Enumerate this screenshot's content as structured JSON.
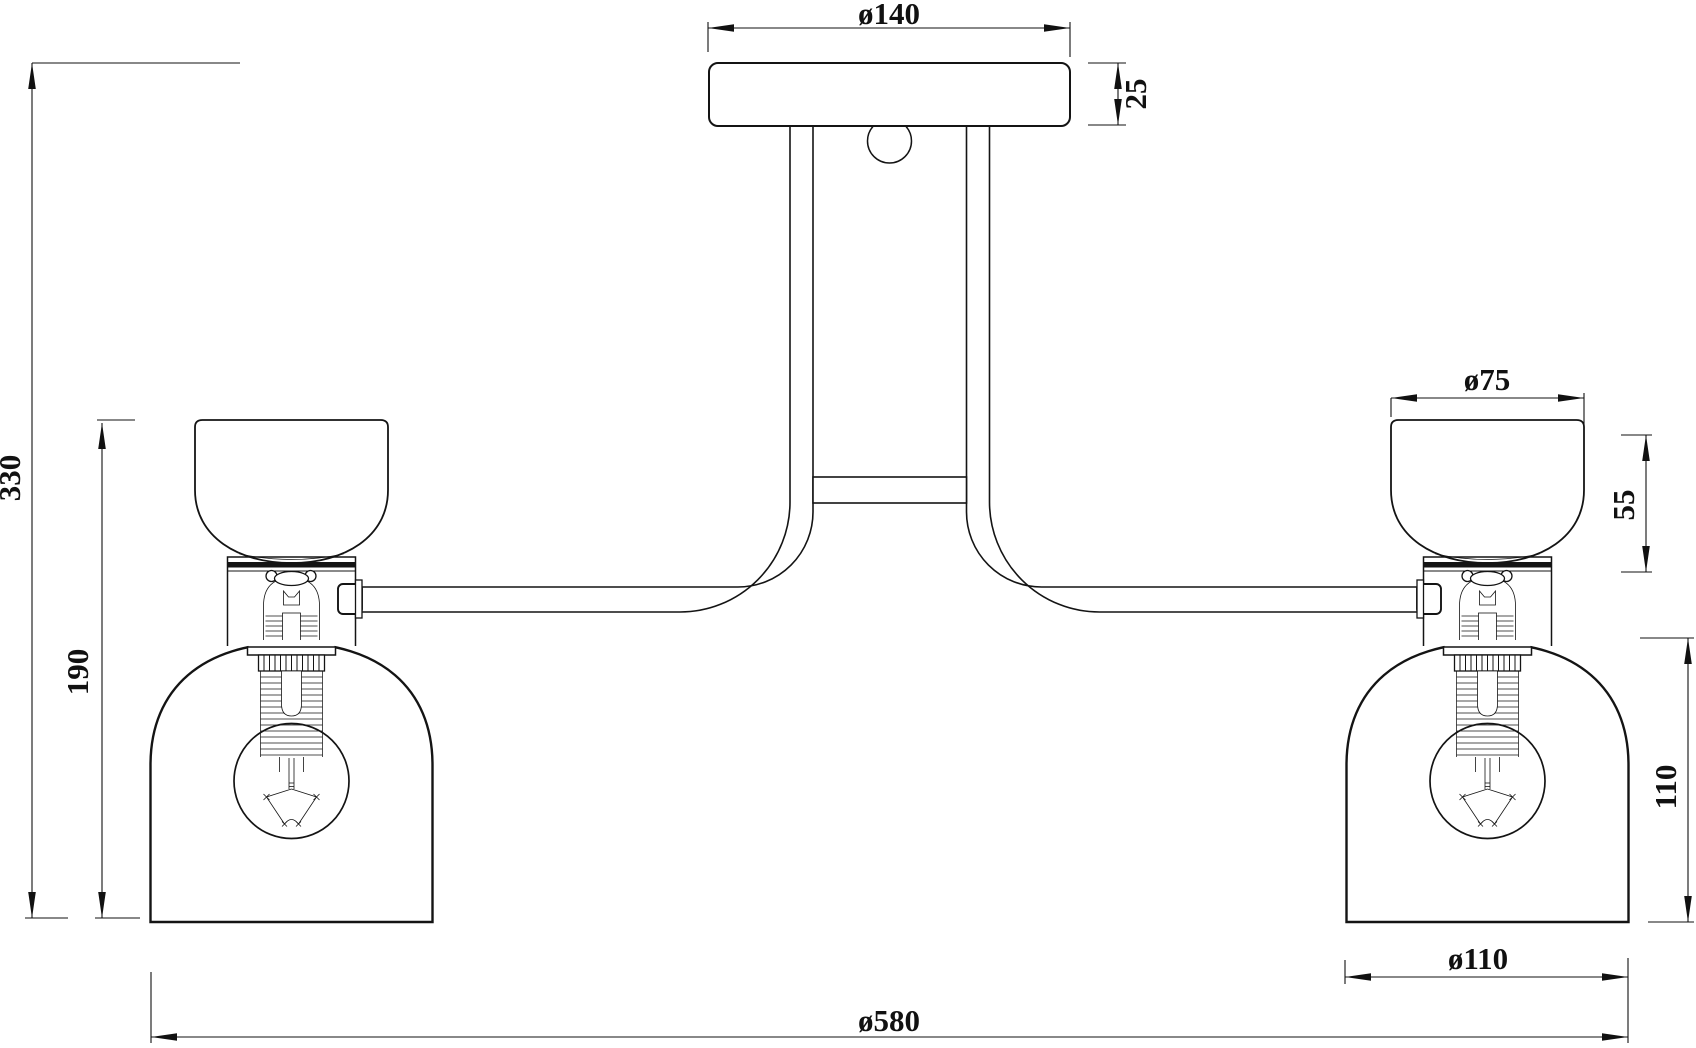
{
  "drawing": {
    "type": "technical-dimension-drawing",
    "subject": "two-light ceiling fixture, front elevation",
    "background_color": "#ffffff",
    "line_color": "#141414",
    "dimensions": {
      "canopy_diameter": "ø140",
      "canopy_height": "25",
      "overall_height": "330",
      "lamp_assembly_height": "190",
      "cup_diameter": "ø75",
      "cup_height": "55",
      "shade_height": "110",
      "shade_diameter": "ø110",
      "overall_width": "ø580"
    }
  }
}
